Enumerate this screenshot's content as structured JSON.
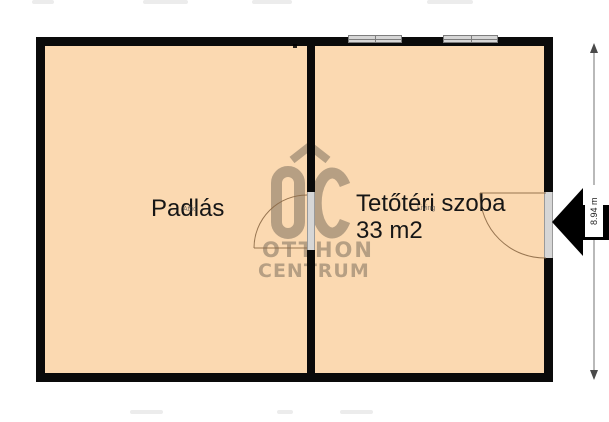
{
  "rooms": [
    {
      "label": "Padlás",
      "type_tag": "Attic"
    },
    {
      "label": "Tetőtéri szoba",
      "area": "33 m2",
      "type_tag": "Living"
    }
  ],
  "dimension": {
    "height_label": "8.94 m"
  },
  "watermark": {
    "monogram": "ÓC",
    "name_line1": "OTTHON",
    "name_line2": "CENTRUM"
  },
  "icons": {
    "entrance_arrow": "solid-left-arrow",
    "dimension_arrows": "double-ended-vertical-arrow",
    "logo_roof": "roof-chevron"
  },
  "colors": {
    "room_fill": "#fbd9b1",
    "wall": "#0a0a0a",
    "watermark": "#8b7a68",
    "window_fill": "#d6d6d6",
    "door_line": "#8c6946",
    "dimension_line": "#737373",
    "arrow": "#000000",
    "background": "#ffffff"
  }
}
